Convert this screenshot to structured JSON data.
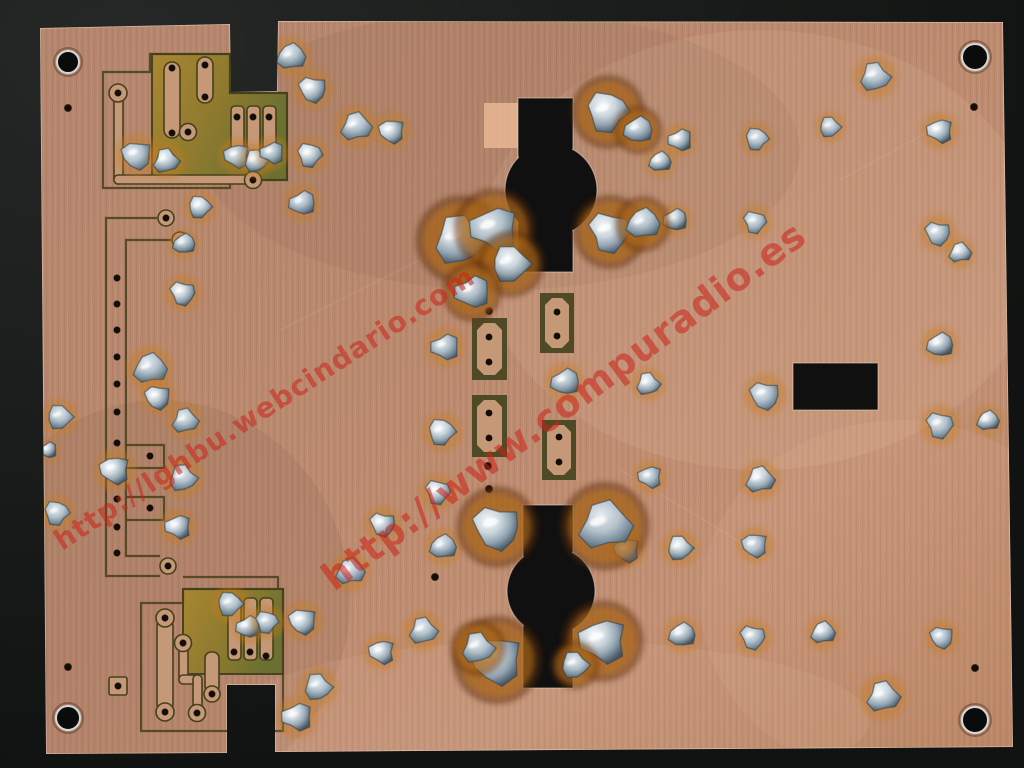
{
  "scene": {
    "alt": "Photograph of the copper solder side of a single-sided printed circuit board on a black background, with etched traces, drilled holes, solder blobs and two keyhole-shaped cutouts",
    "background_color": "#151716",
    "board": {
      "copper_color": "#bb8a6f",
      "copper_light": "#c99a7e",
      "copper_dark": "#a87b60",
      "trace_copper": "#c59878",
      "etch_olive_light": "#a9872e",
      "etch_olive_mid": "#8d7a2c",
      "etch_olive_dark": "#68702f",
      "outline_line": "#45401c",
      "hole_color": "#120d07",
      "solder_light": "#f5f8fa",
      "solder_dark": "#47535f",
      "flux_orange": "#c87d1e",
      "flux_brown": "#5e2f08",
      "edge_highlight": "rgba(245,225,205,0.55)",
      "outline": [
        [
          40,
          28
        ],
        [
          230,
          24
        ],
        [
          231,
          92
        ],
        [
          277,
          91
        ],
        [
          278,
          21
        ],
        [
          1003,
          22
        ],
        [
          1013,
          747
        ],
        [
          275,
          752
        ],
        [
          275,
          685
        ],
        [
          227,
          685
        ],
        [
          227,
          753
        ],
        [
          46,
          754
        ]
      ],
      "mounting_holes": [
        [
          68,
          62,
          11
        ],
        [
          975,
          57,
          13
        ],
        [
          68,
          718,
          12
        ],
        [
          975,
          720,
          13
        ]
      ],
      "small_holes": [
        [
          68,
          108
        ],
        [
          974,
          107
        ],
        [
          68,
          667
        ],
        [
          975,
          668
        ],
        [
          489,
          311
        ],
        [
          488,
          466
        ],
        [
          489,
          489
        ],
        [
          435,
          577
        ]
      ],
      "cutouts": {
        "top_keyhole": {
          "slot": [
            518,
            98,
            55,
            174
          ],
          "circle": [
            551,
            190,
            46
          ]
        },
        "bottom_keyhole": {
          "slot": [
            523,
            505,
            50,
            183
          ],
          "circle": [
            551,
            591,
            44
          ]
        },
        "right_rect": [
          793,
          363,
          85,
          47
        ]
      },
      "copper_patch": [
        484,
        103,
        37,
        45
      ],
      "etched_regions": [
        "M152,54 H230 V93 H287 V180 H152 Z",
        "M183,589 H283 V674 H183 Z"
      ],
      "trace_outlines": [
        "M103,72 H150 V54 H230 V93 H287 V180 H230 V188 H103 Z",
        "M157,218 H106 V576 H160",
        "M171,240 H126 V556 H160",
        "M126,445 H164 V468 H126",
        "M126,497 H164 V520 H126",
        "M141,603 V731 H283 V589 H183 V603 Z",
        "M183,577 H278 V589"
      ],
      "copper_rects": [
        [
          164,
          62,
          16,
          76,
          8
        ],
        [
          197,
          57,
          16,
          46,
          8
        ],
        [
          231,
          106,
          13,
          54,
          4
        ],
        [
          247,
          106,
          13,
          54,
          4
        ],
        [
          263,
          106,
          13,
          54,
          4
        ],
        [
          114,
          98,
          9,
          86,
          4
        ],
        [
          114,
          175,
          146,
          9,
          4
        ],
        [
          157,
          618,
          16,
          94,
          8
        ],
        [
          179,
          643,
          9,
          40,
          4
        ],
        [
          179,
          675,
          22,
          9,
          4
        ],
        [
          193,
          675,
          9,
          38,
          4
        ],
        [
          205,
          652,
          14,
          40,
          6
        ],
        [
          228,
          598,
          13,
          62,
          4
        ],
        [
          244,
          598,
          13,
          62,
          4
        ],
        [
          260,
          598,
          13,
          62,
          4
        ],
        [
          109,
          677,
          18,
          18,
          2
        ]
      ],
      "copper_pads": [
        [
          118,
          93,
          9
        ],
        [
          140,
          157,
          9
        ],
        [
          166,
          160,
          9
        ],
        [
          188,
          132,
          8.5
        ],
        [
          253,
          180,
          8.5
        ],
        [
          166,
          218,
          8
        ],
        [
          180,
          240,
          8
        ],
        [
          168,
          566,
          8
        ],
        [
          165,
          618,
          9
        ],
        [
          165,
          712,
          9
        ],
        [
          183,
          643,
          8.5
        ],
        [
          197,
          713,
          8.5
        ],
        [
          212,
          694,
          8
        ]
      ],
      "trace_holes": [
        [
          118,
          93
        ],
        [
          172,
          68
        ],
        [
          172,
          133
        ],
        [
          205,
          65
        ],
        [
          205,
          97
        ],
        [
          188,
          132
        ],
        [
          253,
          180
        ],
        [
          237,
          117
        ],
        [
          253,
          117
        ],
        [
          269,
          117
        ],
        [
          166,
          218
        ],
        [
          180,
          240
        ],
        [
          168,
          566
        ],
        [
          117,
          278
        ],
        [
          117,
          304
        ],
        [
          117,
          330
        ],
        [
          117,
          357
        ],
        [
          117,
          384
        ],
        [
          117,
          412
        ],
        [
          117,
          443
        ],
        [
          117,
          472
        ],
        [
          117,
          499
        ],
        [
          117,
          527
        ],
        [
          117,
          553
        ],
        [
          150,
          456
        ],
        [
          150,
          508
        ],
        [
          165,
          618
        ],
        [
          165,
          712
        ],
        [
          183,
          643
        ],
        [
          197,
          713
        ],
        [
          212,
          694
        ],
        [
          234,
          652
        ],
        [
          250,
          652
        ],
        [
          266,
          656
        ],
        [
          118,
          686
        ]
      ],
      "pad_frames": [
        {
          "rect": [
            472,
            318,
            35,
            62
          ],
          "holes": [
            [
              489,
              337
            ],
            [
              489,
              362
            ]
          ]
        },
        {
          "rect": [
            540,
            293,
            34,
            60
          ],
          "holes": [
            [
              557,
              312
            ],
            [
              557,
              336
            ]
          ]
        },
        {
          "rect": [
            472,
            395,
            35,
            62
          ],
          "holes": [
            [
              489,
              413
            ],
            [
              489,
              438
            ]
          ]
        },
        {
          "rect": [
            542,
            420,
            34,
            60
          ],
          "holes": [
            [
              559,
              437
            ],
            [
              559,
              462
            ]
          ]
        }
      ],
      "solder_blobs": [
        [
          291,
          57,
          13
        ],
        [
          313,
          89,
          13
        ],
        [
          356,
          127,
          14
        ],
        [
          392,
          131,
          12
        ],
        [
          875,
          77,
          14
        ],
        [
          940,
          131,
          12
        ],
        [
          830,
          127,
          10
        ],
        [
          680,
          140,
          11
        ],
        [
          757,
          139,
          11
        ],
        [
          675,
          220,
          11
        ],
        [
          755,
          222,
          11
        ],
        [
          660,
          162,
          10
        ],
        [
          938,
          233,
          12
        ],
        [
          960,
          253,
          10
        ],
        [
          137,
          155,
          14
        ],
        [
          166,
          161,
          12
        ],
        [
          237,
          156,
          12
        ],
        [
          256,
          161,
          11
        ],
        [
          272,
          153,
          11
        ],
        [
          200,
          207,
          11
        ],
        [
          302,
          203,
          12
        ],
        [
          310,
          155,
          12
        ],
        [
          184,
          244,
          10
        ],
        [
          183,
          293,
          12
        ],
        [
          150,
          369,
          15
        ],
        [
          158,
          397,
          12
        ],
        [
          185,
          421,
          12
        ],
        [
          115,
          470,
          14
        ],
        [
          183,
          478,
          13
        ],
        [
          178,
          527,
          12
        ],
        [
          60,
          417,
          12
        ],
        [
          48,
          450,
          8
        ],
        [
          57,
          513,
          12
        ],
        [
          940,
          345,
          12
        ],
        [
          940,
          425,
          13
        ],
        [
          988,
          421,
          10
        ],
        [
          765,
          395,
          14
        ],
        [
          760,
          480,
          13
        ],
        [
          755,
          545,
          12
        ],
        [
          648,
          384,
          11
        ],
        [
          650,
          477,
          11
        ],
        [
          680,
          548,
          12
        ],
        [
          445,
          347,
          13
        ],
        [
          442,
          432,
          13
        ],
        [
          565,
          382,
          13
        ],
        [
          438,
          492,
          12
        ],
        [
          443,
          547,
          12
        ],
        [
          383,
          524,
          12
        ],
        [
          350,
          572,
          13
        ],
        [
          303,
          621,
          13
        ],
        [
          423,
          631,
          13
        ],
        [
          382,
          652,
          12
        ],
        [
          318,
          687,
          13
        ],
        [
          297,
          717,
          14
        ],
        [
          230,
          604,
          12
        ],
        [
          248,
          627,
          11
        ],
        [
          267,
          622,
          11
        ],
        [
          682,
          635,
          12
        ],
        [
          753,
          637,
          12
        ],
        [
          823,
          633,
          11
        ],
        [
          942,
          637,
          11
        ],
        [
          883,
          697,
          15
        ],
        [
          627,
          550,
          12
        ],
        [
          460,
          240,
          24,
          1
        ],
        [
          494,
          229,
          22,
          1
        ],
        [
          511,
          264,
          18,
          1
        ],
        [
          472,
          292,
          16,
          1
        ],
        [
          608,
          112,
          20,
          1
        ],
        [
          638,
          130,
          13,
          1
        ],
        [
          610,
          232,
          20,
          1
        ],
        [
          643,
          224,
          15,
          1
        ],
        [
          497,
          527,
          22,
          1
        ],
        [
          605,
          526,
          24,
          1
        ],
        [
          497,
          660,
          24,
          1
        ],
        [
          478,
          648,
          15,
          1
        ],
        [
          603,
          641,
          22,
          1
        ],
        [
          575,
          665,
          13,
          1
        ]
      ]
    }
  },
  "watermarks": [
    {
      "text": "http://lghbu.webcindario.com",
      "color": "#cc2018"
    },
    {
      "text": "http://www.compuradio.es",
      "color": "#cc2018"
    }
  ]
}
